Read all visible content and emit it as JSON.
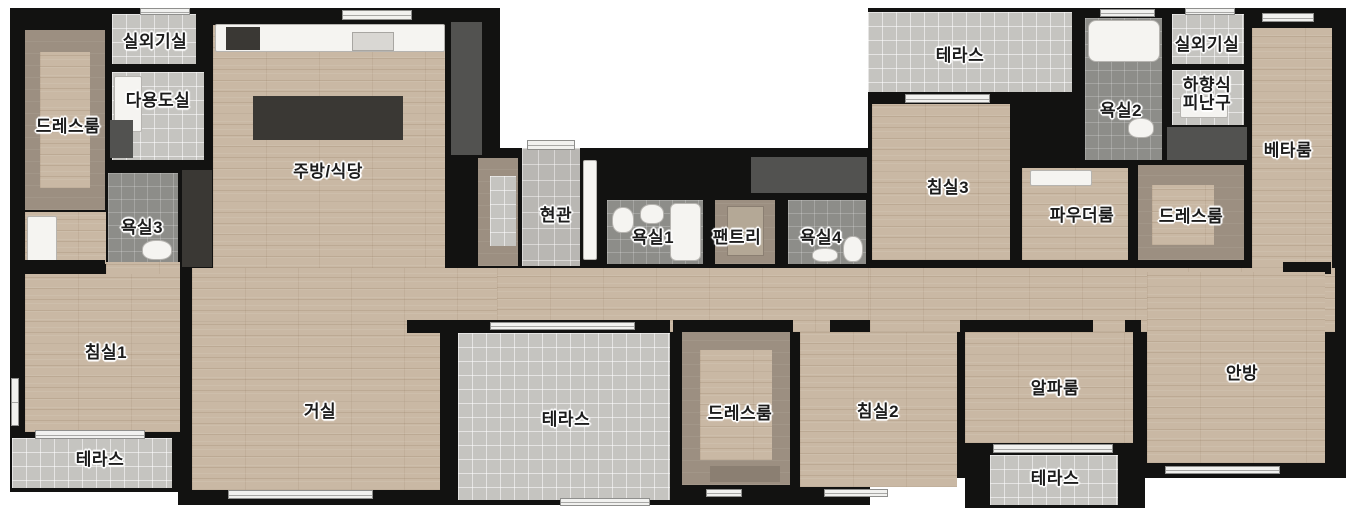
{
  "title": "apartment-floor-plan",
  "colors": {
    "wall": "#121211",
    "wood_floor": "#c9b8a4",
    "terrace_tile": "#c5c4c0",
    "bathroom_tile": "#8d8d89",
    "dressroom_taupe": "#9c8f81",
    "fixture_white": "#f5f4f1",
    "feature_darkgray": "#525250",
    "island_charcoal": "#3a3834"
  },
  "rooms": {
    "outdoor_left": {
      "label": "실외기실"
    },
    "utility": {
      "label": "다용도실"
    },
    "dress_left": {
      "label": "드레스룸"
    },
    "bath3": {
      "label": "욕실3"
    },
    "kitchen_dining": {
      "label": "주방/식당"
    },
    "entrance": {
      "label": "현관"
    },
    "bath1": {
      "label": "욕실1"
    },
    "pantry": {
      "label": "팬트리"
    },
    "bath4": {
      "label": "욕실4"
    },
    "terrace_top": {
      "label": "테라스"
    },
    "bed3": {
      "label": "침실3"
    },
    "bath2": {
      "label": "욕실2"
    },
    "outdoor_right": {
      "label": "실외기실"
    },
    "escape": {
      "label_line1": "하향식",
      "label_line2": "피난구"
    },
    "beta": {
      "label": "베타룸"
    },
    "powder": {
      "label": "파우더룸"
    },
    "dress_right": {
      "label": "드레스룸"
    },
    "bed1": {
      "label": "침실1"
    },
    "terrace_bottom_left": {
      "label": "테라스"
    },
    "living": {
      "label": "거실"
    },
    "terrace_mid": {
      "label": "테라스"
    },
    "dress_bottom": {
      "label": "드레스룸"
    },
    "bed2": {
      "label": "침실2"
    },
    "alpha": {
      "label": "알파룸"
    },
    "master": {
      "label": "안방"
    },
    "terrace_bottom_right": {
      "label": "테라스"
    }
  }
}
